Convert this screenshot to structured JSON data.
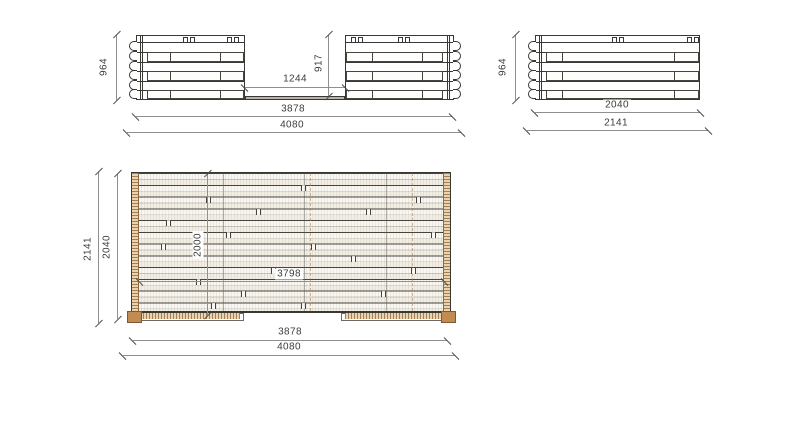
{
  "views": {
    "front_elevation": {
      "dims": {
        "total_height": "964",
        "opening_height": "917",
        "opening_width": "1244",
        "shell_width": "3878",
        "overall_width": "4080"
      }
    },
    "side_elevation": {
      "dims": {
        "total_height": "964",
        "shell_depth": "2040",
        "overall_depth": "2141"
      }
    },
    "plan_view": {
      "dims": {
        "overall_depth": "2141",
        "shell_depth": "2040",
        "inner_depth": "2000",
        "inner_width": "3798",
        "shell_width": "3878",
        "overall_width": "4080"
      }
    }
  },
  "colors": {
    "line": "#3a3835",
    "dim_line": "#8f8f8f",
    "dim_text": "#3c3c3c",
    "wood_light": "#e8d4b0",
    "wood_tick": "#a97c4f",
    "wood_corner": "#c28b52",
    "board_bg": "#f2eee5"
  }
}
